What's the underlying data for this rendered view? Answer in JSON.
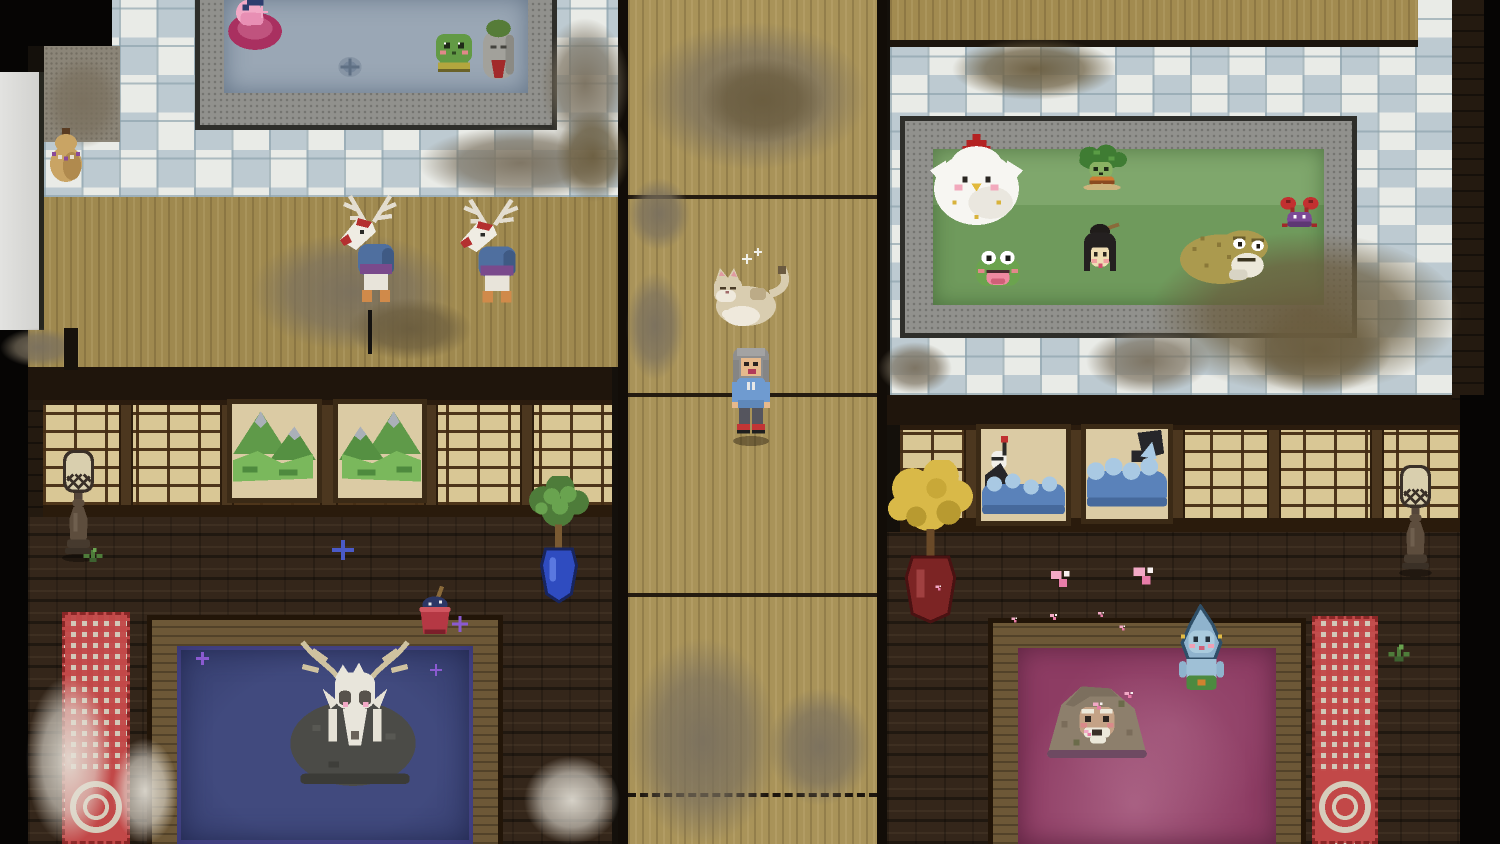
{
  "meta": {
    "scene": "pixel-art bathhouse interior, top-down view",
    "rooms": [
      "tiled-bath-room-top-left",
      "tatami-hall-left",
      "central-wood-corridor",
      "tiled-bath-room-top-right",
      "dark-parlor-bottom-left",
      "dark-parlor-bottom-right"
    ]
  },
  "palette": {
    "tile_white": "#e9ebe7",
    "tile_blue": "#bdcad1",
    "grout": "#8aa0aa",
    "wood_corridor": "#a99359",
    "tatami": "#9f894f",
    "brick_floor": "#34261a",
    "wall_dark": "#241a10",
    "shoji_paper": "#d9c795",
    "shoji_frame": "#4c371f",
    "stone_bath": "#91918d",
    "wood_bath": "#6d5837",
    "water_gray_blue": "#9aa7b5",
    "water_green": "#6f9a5c",
    "water_indigo": "#3a4274",
    "water_plum": "#8d3c63",
    "carpet_red": "#c24848",
    "carpet_cream": "#d6cdbc",
    "dirt_gray": "#7a705e",
    "dirt_brown": "#6a5c3e",
    "dust_white": "#e4e0d6"
  },
  "entities": [
    {
      "name": "dirt-patch",
      "sprite": "dirt-g",
      "x": 418,
      "y": 126,
      "w": 205,
      "h": 74,
      "z": 5,
      "interactable": false
    },
    {
      "name": "dirt-patch",
      "sprite": "dirt-g",
      "x": 540,
      "y": 18,
      "w": 90,
      "h": 132,
      "z": 5,
      "interactable": false
    },
    {
      "name": "dirt-patch",
      "sprite": "dirt-b",
      "x": 556,
      "y": 110,
      "w": 74,
      "h": 92,
      "z": 5,
      "interactable": false
    },
    {
      "name": "dirt-patch",
      "sprite": "dirt-g",
      "x": 250,
      "y": 233,
      "w": 205,
      "h": 118,
      "z": 5,
      "interactable": false
    },
    {
      "name": "dirt-patch",
      "sprite": "dirt-b",
      "x": 348,
      "y": 298,
      "w": 124,
      "h": 62,
      "z": 5,
      "interactable": false
    },
    {
      "name": "dirt-patch",
      "sprite": "dirt-g",
      "x": 0,
      "y": 328,
      "w": 78,
      "h": 39,
      "z": 5,
      "interactable": false
    },
    {
      "name": "dirt-patch",
      "sprite": "dirt-g",
      "x": 640,
      "y": 22,
      "w": 228,
      "h": 148,
      "z": 5,
      "interactable": false
    },
    {
      "name": "dirt-patch",
      "sprite": "dirt-b",
      "x": 700,
      "y": 58,
      "w": 125,
      "h": 85,
      "z": 5,
      "interactable": false
    },
    {
      "name": "dirt-patch",
      "sprite": "dirt-g",
      "x": 628,
      "y": 178,
      "w": 62,
      "h": 72,
      "z": 5,
      "interactable": false
    },
    {
      "name": "dirt-patch",
      "sprite": "dirt-g",
      "x": 626,
      "y": 272,
      "w": 58,
      "h": 108,
      "z": 5,
      "interactable": false
    },
    {
      "name": "dirt-patch",
      "sprite": "dirt-g",
      "x": 628,
      "y": 638,
      "w": 150,
      "h": 206,
      "z": 5,
      "interactable": false
    },
    {
      "name": "dirt-patch",
      "sprite": "dirt-g",
      "x": 768,
      "y": 688,
      "w": 104,
      "h": 118,
      "z": 5,
      "interactable": false
    },
    {
      "name": "dirt-patch",
      "sprite": "dirt-b",
      "x": 952,
      "y": 38,
      "w": 165,
      "h": 62,
      "z": 5,
      "interactable": false
    },
    {
      "name": "dirt-patch",
      "sprite": "dirt-b",
      "x": 1150,
      "y": 232,
      "w": 312,
      "h": 162,
      "z": 5,
      "interactable": false
    },
    {
      "name": "dirt-patch",
      "sprite": "dirt-g",
      "x": 1086,
      "y": 328,
      "w": 124,
      "h": 66,
      "z": 5,
      "interactable": false
    },
    {
      "name": "dirt-patch",
      "sprite": "dirt-g",
      "x": 878,
      "y": 342,
      "w": 74,
      "h": 52,
      "z": 5,
      "interactable": false
    },
    {
      "name": "dirt-patch",
      "sprite": "dirt-b",
      "x": 1240,
      "y": 306,
      "w": 152,
      "h": 88,
      "z": 5,
      "interactable": false
    },
    {
      "name": "dirt-patch",
      "sprite": "dirt-g",
      "x": 44,
      "y": 56,
      "w": 78,
      "h": 92,
      "z": 5,
      "interactable": false
    },
    {
      "name": "dust-patch",
      "sprite": "dust-w",
      "x": 26,
      "y": 676,
      "w": 86,
      "h": 168,
      "z": 15,
      "interactable": false
    },
    {
      "name": "dust-patch",
      "sprite": "dust-w",
      "x": 112,
      "y": 738,
      "w": 66,
      "h": 106,
      "z": 15,
      "interactable": false
    },
    {
      "name": "dust-patch",
      "sprite": "dust-w",
      "x": 524,
      "y": 756,
      "w": 96,
      "h": 88,
      "z": 15,
      "interactable": false
    },
    {
      "name": "carpet-runner-left",
      "sprite": "carpet",
      "x": 62,
      "y": 612,
      "w": 68,
      "h": 232,
      "z": 8,
      "interactable": false
    },
    {
      "name": "carpet-runner-right",
      "sprite": "carpet",
      "x": 1312,
      "y": 616,
      "w": 66,
      "h": 228,
      "z": 8,
      "interactable": false
    },
    {
      "name": "drain",
      "sprite": "drain",
      "x": 336,
      "y": 54,
      "w": 28,
      "h": 26,
      "z": 6,
      "interactable": false
    },
    {
      "name": "spirit-otter-in-ring",
      "sprite": "otter-ring",
      "x": 222,
      "y": -6,
      "w": 64,
      "h": 58,
      "z": 20,
      "interactable": true
    },
    {
      "name": "sparkle-pink",
      "sprite": "spark-pink",
      "x": 256,
      "y": 6,
      "w": 12,
      "h": 12,
      "z": 22,
      "interactable": false
    },
    {
      "name": "spirit-frog-bather",
      "sprite": "frog-kappa",
      "x": 430,
      "y": 28,
      "w": 48,
      "h": 47,
      "z": 20,
      "interactable": true
    },
    {
      "name": "jizo-statue-spirit",
      "sprite": "jizo",
      "x": 479,
      "y": 18,
      "w": 39,
      "h": 65,
      "z": 20,
      "interactable": true
    },
    {
      "name": "gourd-spirit",
      "sprite": "gourd",
      "x": 46,
      "y": 128,
      "w": 40,
      "h": 58,
      "z": 20,
      "interactable": true
    },
    {
      "name": "deer-spirit-walking",
      "sprite": "deer-spirit",
      "x": 338,
      "y": 192,
      "w": 68,
      "h": 122,
      "z": 20,
      "interactable": true
    },
    {
      "name": "walking-staff",
      "sprite": "staff",
      "x": 368,
      "y": 310,
      "w": 4,
      "h": 44,
      "z": 19,
      "interactable": false
    },
    {
      "name": "deer-spirit-walking",
      "sprite": "deer-spirit",
      "x": 458,
      "y": 196,
      "w": 70,
      "h": 118,
      "z": 20,
      "interactable": true
    },
    {
      "name": "cat-lying",
      "sprite": "cat",
      "x": 710,
      "y": 262,
      "w": 88,
      "h": 68,
      "z": 20,
      "interactable": true
    },
    {
      "name": "sparkle-white",
      "sprite": "spark-white",
      "x": 742,
      "y": 254,
      "w": 10,
      "h": 10,
      "z": 22,
      "interactable": false
    },
    {
      "name": "sparkle-white",
      "sprite": "spark-white",
      "x": 754,
      "y": 248,
      "w": 8,
      "h": 8,
      "z": 22,
      "interactable": false
    },
    {
      "name": "player-character",
      "sprite": "player",
      "x": 727,
      "y": 344,
      "w": 48,
      "h": 102,
      "z": 21,
      "interactable": true
    },
    {
      "name": "spirit-chicken",
      "sprite": "chicken",
      "x": 928,
      "y": 134,
      "w": 97,
      "h": 95,
      "z": 20,
      "interactable": true
    },
    {
      "name": "spirit-kappa",
      "sprite": "kappa",
      "x": 1073,
      "y": 144,
      "w": 56,
      "h": 46,
      "z": 20,
      "interactable": true
    },
    {
      "name": "spirit-frog-singing",
      "sprite": "frog-mouth",
      "x": 972,
      "y": 248,
      "w": 52,
      "h": 42,
      "z": 20,
      "interactable": true
    },
    {
      "name": "spirit-woman-bather",
      "sprite": "woman",
      "x": 1076,
      "y": 222,
      "w": 48,
      "h": 68,
      "z": 20,
      "interactable": true
    },
    {
      "name": "spirit-toad",
      "sprite": "toad",
      "x": 1176,
      "y": 222,
      "w": 96,
      "h": 64,
      "z": 20,
      "interactable": true
    },
    {
      "name": "spirit-crab",
      "sprite": "crab",
      "x": 1277,
      "y": 196,
      "w": 45,
      "h": 38,
      "z": 20,
      "interactable": true
    },
    {
      "name": "deer-skull-spirit",
      "sprite": "deer-skull",
      "x": 268,
      "y": 628,
      "w": 172,
      "h": 168,
      "z": 20,
      "interactable": true
    },
    {
      "name": "mountain-monkey-spirit",
      "sprite": "monkey",
      "x": 1041,
      "y": 672,
      "w": 112,
      "h": 88,
      "z": 20,
      "interactable": true
    },
    {
      "name": "teardrop-spirit",
      "sprite": "teardrop",
      "x": 1170,
      "y": 604,
      "w": 63,
      "h": 94,
      "z": 21,
      "interactable": true
    },
    {
      "name": "stone-lantern",
      "sprite": "lantern",
      "x": 57,
      "y": 448,
      "w": 43,
      "h": 114,
      "z": 12,
      "interactable": true
    },
    {
      "name": "stone-lantern",
      "sprite": "lantern",
      "x": 1394,
      "y": 463,
      "w": 43,
      "h": 114,
      "z": 12,
      "interactable": true
    },
    {
      "name": "potted-tree-blue-vase",
      "sprite": "plant-blue",
      "x": 527,
      "y": 476,
      "w": 64,
      "h": 134,
      "z": 12,
      "interactable": true
    },
    {
      "name": "potted-tree-red-vase",
      "sprite": "tree-yellow",
      "x": 888,
      "y": 460,
      "w": 87,
      "h": 170,
      "z": 12,
      "interactable": true
    },
    {
      "name": "bucket-with-cloth",
      "sprite": "bucket",
      "x": 414,
      "y": 586,
      "w": 42,
      "h": 54,
      "z": 12,
      "interactable": true
    },
    {
      "name": "painting-mountains",
      "sprite": "paint-mtn",
      "x": 227,
      "y": 399,
      "w": 95,
      "h": 104,
      "z": 11,
      "interactable": true
    },
    {
      "name": "painting-mountains",
      "sprite": "paint-mtn",
      "x": 333,
      "y": 399,
      "w": 94,
      "h": 104,
      "z": 11,
      "flip": true,
      "interactable": true
    },
    {
      "name": "painting-crane-waves",
      "sprite": "paint-wave1",
      "x": 976,
      "y": 424,
      "w": 95,
      "h": 102,
      "z": 11,
      "interactable": true
    },
    {
      "name": "painting-great-wave",
      "sprite": "paint-wave2",
      "x": 1081,
      "y": 424,
      "w": 92,
      "h": 100,
      "z": 11,
      "interactable": true
    },
    {
      "name": "grass-sprig",
      "sprite": "grass",
      "x": 80,
      "y": 546,
      "w": 26,
      "h": 18,
      "z": 13,
      "interactable": false
    },
    {
      "name": "grass-sprig",
      "sprite": "grass",
      "x": 1384,
      "y": 642,
      "w": 30,
      "h": 22,
      "z": 13,
      "interactable": false
    },
    {
      "name": "sparkle-blue",
      "sprite": "spark-blue",
      "x": 332,
      "y": 540,
      "w": 22,
      "h": 20,
      "z": 13,
      "interactable": false
    },
    {
      "name": "sparkle-purple",
      "sprite": "spark-purple",
      "x": 452,
      "y": 616,
      "w": 16,
      "h": 16,
      "z": 13,
      "interactable": false
    },
    {
      "name": "sparkle-purple",
      "sprite": "spark-purple",
      "x": 196,
      "y": 652,
      "w": 13,
      "h": 13,
      "z": 22,
      "interactable": false
    },
    {
      "name": "sparkle-purple",
      "sprite": "spark-purple",
      "x": 430,
      "y": 664,
      "w": 12,
      "h": 12,
      "z": 22,
      "interactable": false
    },
    {
      "name": "petal-pink",
      "sprite": "petal",
      "x": 1046,
      "y": 566,
      "w": 26,
      "h": 26,
      "z": 13,
      "interactable": false
    },
    {
      "name": "petal-pink",
      "sprite": "petal",
      "x": 1128,
      "y": 562,
      "w": 28,
      "h": 28,
      "z": 13,
      "interactable": false
    },
    {
      "name": "petal-pink",
      "sprite": "petal",
      "x": 1048,
      "y": 612,
      "w": 10,
      "h": 10,
      "z": 22,
      "interactable": false
    },
    {
      "name": "petal-pink",
      "sprite": "petal",
      "x": 1010,
      "y": 616,
      "w": 8,
      "h": 8,
      "z": 22,
      "interactable": false
    },
    {
      "name": "petal-pink",
      "sprite": "petal",
      "x": 1096,
      "y": 610,
      "w": 9,
      "h": 9,
      "z": 22,
      "interactable": false
    },
    {
      "name": "petal-pink",
      "sprite": "petal",
      "x": 1118,
      "y": 624,
      "w": 8,
      "h": 8,
      "z": 22,
      "interactable": false
    },
    {
      "name": "petal-pink",
      "sprite": "petal",
      "x": 934,
      "y": 584,
      "w": 8,
      "h": 8,
      "z": 13,
      "interactable": false
    },
    {
      "name": "petal-pink",
      "sprite": "petal",
      "x": 1090,
      "y": 700,
      "w": 14,
      "h": 12,
      "z": 22,
      "interactable": false
    },
    {
      "name": "petal-pink",
      "sprite": "petal",
      "x": 1122,
      "y": 690,
      "w": 12,
      "h": 10,
      "z": 22,
      "interactable": false
    },
    {
      "name": "petal-pink",
      "sprite": "petal",
      "x": 1082,
      "y": 728,
      "w": 11,
      "h": 10,
      "z": 22,
      "interactable": false
    },
    {
      "name": "black-post",
      "sprite": "post",
      "x": 64,
      "y": 328,
      "w": 14,
      "h": 42,
      "z": 12,
      "interactable": false
    }
  ]
}
